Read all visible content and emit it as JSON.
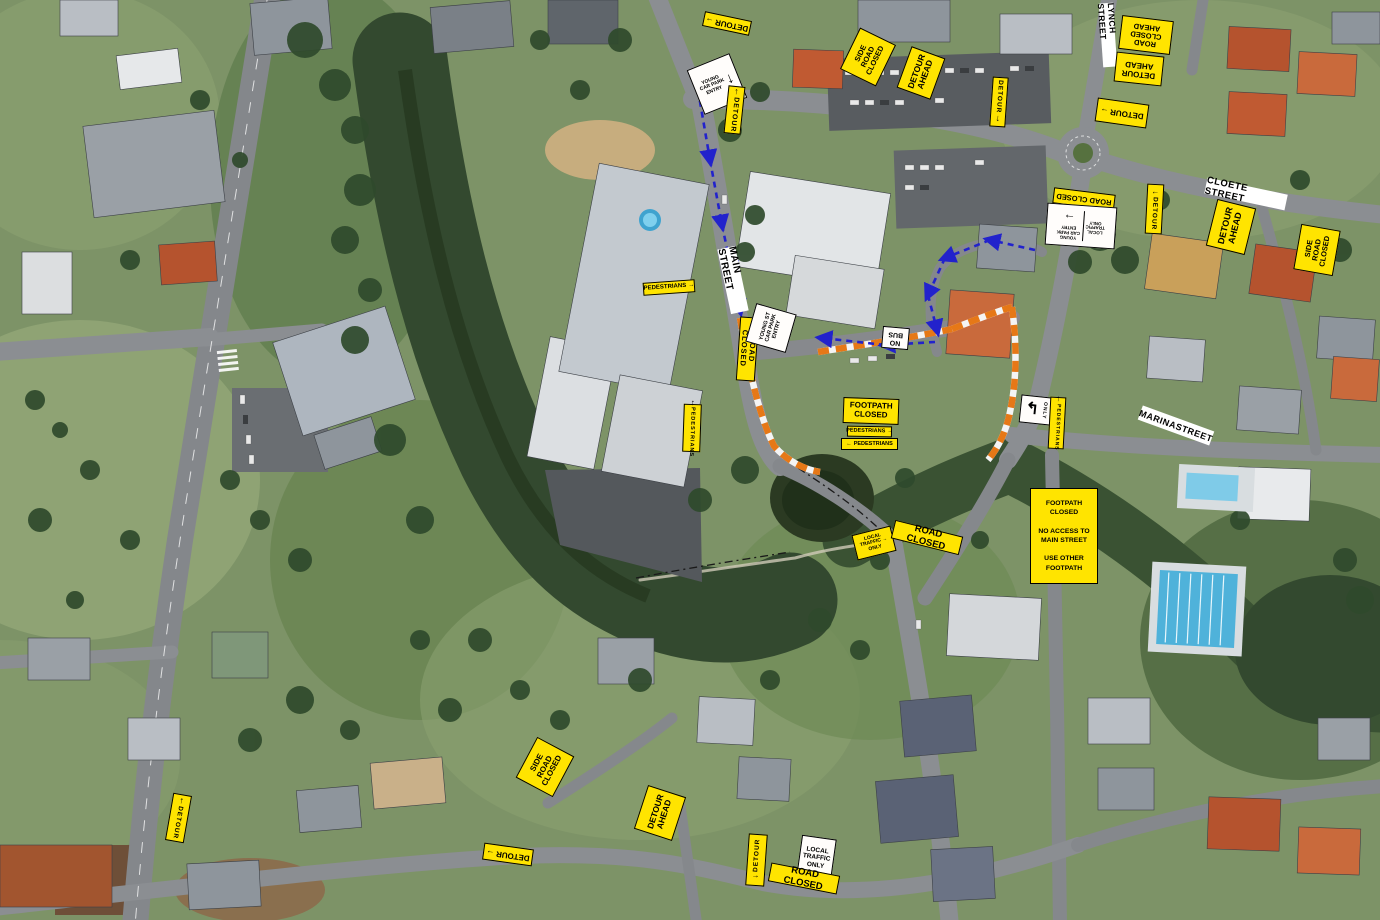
{
  "colors": {
    "sign_yellow": "#ffe400",
    "sign_white": "#ffffff",
    "barrier_orange": "#e67817",
    "detour_path_blue": "#2222cc"
  },
  "street_labels": {
    "lynch": "LYNCH STREET",
    "cloete": "CLOETE STREET",
    "main": "MAIN STREET",
    "marina": "MARINASTREET"
  },
  "signs": {
    "detour_top_left": {
      "label": "DETOUR",
      "arrow": "→"
    },
    "young_carpark_top": {
      "lines": "YOUNG\nCAR PARK\nENTRY",
      "arrow": "↓"
    },
    "detour_vert_top": {
      "label": "DETOUR",
      "arrow": "↑"
    },
    "side_road_closed_nw": {
      "lines": "SIDE\nROAD\nCLOSED"
    },
    "detour_ahead_nw": {
      "lines": "DETOUR\nAHEAD"
    },
    "detour_vert_nw": {
      "label": "DETOUR",
      "arrow": "↓"
    },
    "road_closed_ahead_ne": {
      "lines": "ROAD\nCLOSED\nAHEAD"
    },
    "detour_ahead_ne": {
      "lines": "DETOUR\nAHEAD"
    },
    "detour_ne": {
      "label": "DETOUR",
      "arrow": "→"
    },
    "road_closed_young": {
      "label": "ROAD CLOSED"
    },
    "combo_local_traffic": {
      "arrow": "→",
      "young": "YOUNG\nCAR PARK\nENTRY",
      "local": "LOCAL\nTRAFFIC\nONLY"
    },
    "detour_vert_cloete": {
      "label": "DETOUR",
      "arrow": "←"
    },
    "detour_ahead_cloete": {
      "lines": "DETOUR\nAHEAD"
    },
    "side_road_closed_cloete": {
      "lines": "SIDE\nROAD\nCLOSED"
    },
    "pedestrians_main_n": {
      "label": "PEDESTRIANS",
      "arrow": "→"
    },
    "road_closed_main": {
      "label": "ROAD CLOSED"
    },
    "young_st_carpark": {
      "lines": "YOUNG ST\nCAR PARK\nENTRY"
    },
    "pedestrians_vert_main": {
      "label": "PEDESTRIANS",
      "arrow": "↑"
    },
    "no_bus": {
      "lines": "NO\nBUS"
    },
    "footpath_closed_park": {
      "lines": "FOOTPATH\nCLOSED"
    },
    "pedestrians_e": {
      "label": "PEDESTRIANS",
      "arrow": "→"
    },
    "pedestrians_w": {
      "label": "PEDESTRIANS",
      "arrow": "←"
    },
    "turn_only": {
      "arrow": "↰",
      "label": "ONLY"
    },
    "pedestrians_vert_marina": {
      "label": "PEDESTRIANS",
      "arrow": "↑"
    },
    "local_traffic_bridge": {
      "lines": "LOCAL\nTRAFFIC →\nONLY"
    },
    "road_closed_bridge": {
      "label": "ROAD CLOSED"
    },
    "footpath_notice": {
      "lines": "FOOTPATH\nCLOSED\n\nNO ACCESS TO\nMAIN STREET\n\nUSE OTHER\nFOOTPATH"
    },
    "side_road_closed_s": {
      "lines": "SIDE\nROAD\nCLOSED"
    },
    "detour_ahead_s": {
      "lines": "DETOUR\nAHEAD"
    },
    "detour_s": {
      "label": "DETOUR",
      "arrow": "→"
    },
    "detour_vert_s": {
      "label": "DETOUR",
      "arrow": "←"
    },
    "local_traffic_s": {
      "lines": "LOCAL\nTRAFFIC\nONLY"
    },
    "road_closed_s": {
      "label": "ROAD CLOSED"
    },
    "detour_vert_sw": {
      "label": "DETOUR",
      "arrow": "↑"
    }
  }
}
